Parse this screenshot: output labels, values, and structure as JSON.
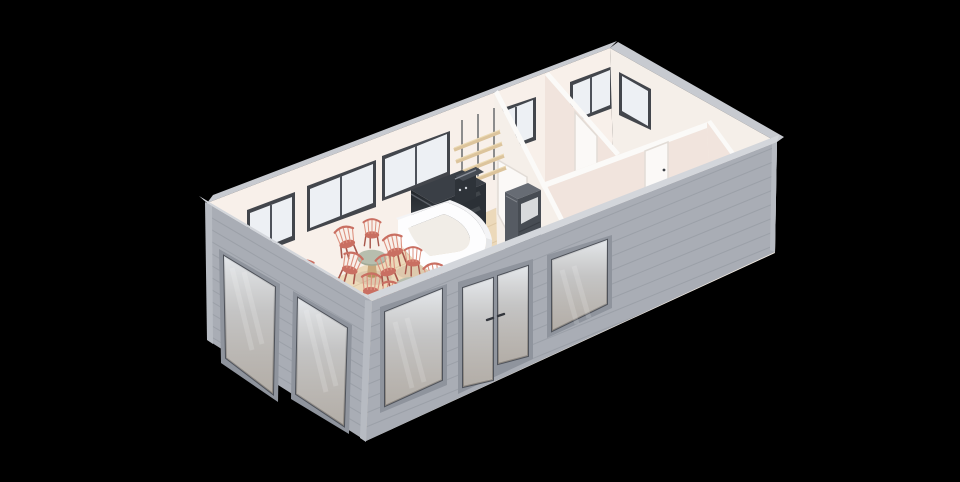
{
  "meta": {
    "width": 960,
    "height": 482,
    "description": "Isometric 3D render of a cafe floor plan on a black background: left half is a dining room with wood floor, two round pedestal tables and coral windsor chairs, a white curved service counter, dark back bar with espresso machine, wooden wall shelves and a dark refrigerator; right half holds three empty back rooms with white walls, interior doors and windows; gray exterior siding walls with large glazed windows and a double glass entrance door."
  },
  "palette": {
    "bg": "#000000",
    "exterior_wall": "#a9adb5",
    "exterior_trim": "#b7bbc2",
    "siding_line": "rgba(60,64,72,0.12)",
    "roof_cap": "#c7cad0",
    "roof_cap_bright": "#d3d6db",
    "interior_wall_nw": "#f8f0ea",
    "interior_wall_ne": "#f5efe9",
    "partition_face": "#f1e4dd",
    "wall_top": "#fbfaf8",
    "floor_back": "#f2ebe3",
    "floor_wood": "#ecd9ba",
    "floor_wood_line": "#dfc9a6",
    "window_frame_dark": "#43464c",
    "glass_cool": "#edf0f4",
    "facade_frame": "#8f949d",
    "facade_sash": "#4e525a",
    "door_white": "#fbf9f7",
    "door_frame": "#e2dcd6",
    "handle": "#3f4348",
    "counter_white": "#fdfdfe",
    "counter_face": "#f4f4f6",
    "counter_inner": "#f1ede7",
    "backbar_top": "#3a3f46",
    "backbar_front": "#272b31",
    "backbar_side": "#2b3036",
    "machine_front": "#2e3339",
    "machine_top": "#454b53",
    "steel": "#8b9099",
    "fridge_top": "#676c74",
    "fridge_sw": "#565b63",
    "fridge_se": "#474c53",
    "fridge_panel": "#d8dadc",
    "shelf_wood": "#dcc49c",
    "shelf_wood_hi": "#ecdab4",
    "rod": "#45494f",
    "table_top": "#b7beae",
    "table_rim": "#a2a996",
    "pedestal": "#c9a87c",
    "pedestal_dark": "#b3925f",
    "chair": "#c96f62",
    "chair_dark": "#a8564b",
    "chair_light": "#dd917f",
    "shadow": "rgba(90,70,60,0.10)",
    "baseboard": "rgba(60,50,45,0.08)"
  },
  "scene": {
    "render_type": "isometric floor plan",
    "background": "black",
    "cafe_area": {
      "dining_tables": 2,
      "chairs": 13,
      "service_counter": 1,
      "back_bar": 1,
      "espresso_machine": 1,
      "wall_shelves": 4,
      "refrigerator": 1,
      "back_wall_windows": 3,
      "floor": "light wood planks"
    },
    "back_rooms": {
      "rooms": 3,
      "interior_doors": 3,
      "back_wall_windows": 2,
      "right_wall_windows": 1,
      "floor": "pale cream"
    },
    "facade": {
      "left_end_windows": 2,
      "front_windows": 2,
      "entrance_double_glass_door": 1,
      "material": "gray horizontal siding"
    }
  }
}
